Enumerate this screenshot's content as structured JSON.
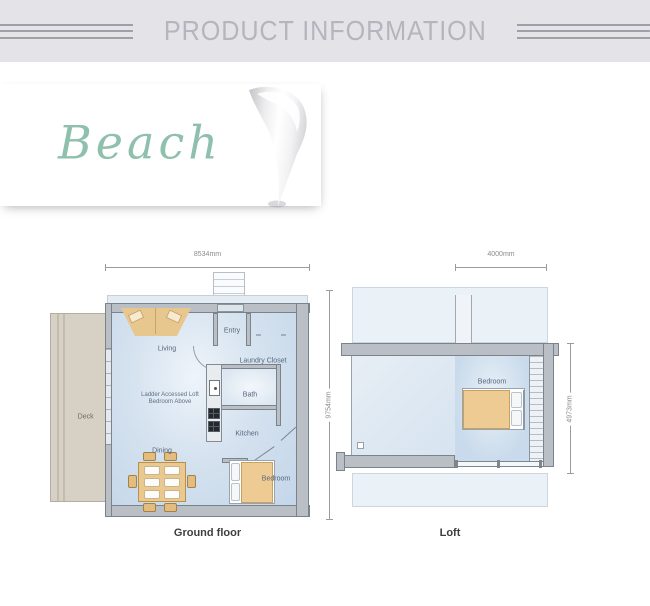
{
  "header": {
    "title": "PRODUCT INFORMATION"
  },
  "brand": {
    "name": "Beach"
  },
  "ground_floor": {
    "caption": "Ground floor",
    "dim_width": "8534mm",
    "dim_height": "9754mm",
    "deck_label": "Deck",
    "note_line1": "Ladder Accessed Loft",
    "note_line2": "Bedroom Above",
    "rooms": {
      "living": "Living",
      "entry": "Entry",
      "laundry": "Laundry Closet",
      "bath": "Bath",
      "kitchen": "Kitchen",
      "dining": "Dining",
      "bedroom": "Bedroom"
    }
  },
  "loft": {
    "caption": "Loft",
    "dim_width": "4000mm",
    "dim_height": "4973mm",
    "rooms": {
      "bedroom": "Bedroom"
    }
  },
  "colors": {
    "accent_green": "#8fc0ad",
    "header_bg": "#e4e3e8",
    "floor_blue": "#cfdeed",
    "wall_gray": "#b9bfc5",
    "furniture_tan": "#e9c98f",
    "deck_tan": "#d7d0c5"
  }
}
